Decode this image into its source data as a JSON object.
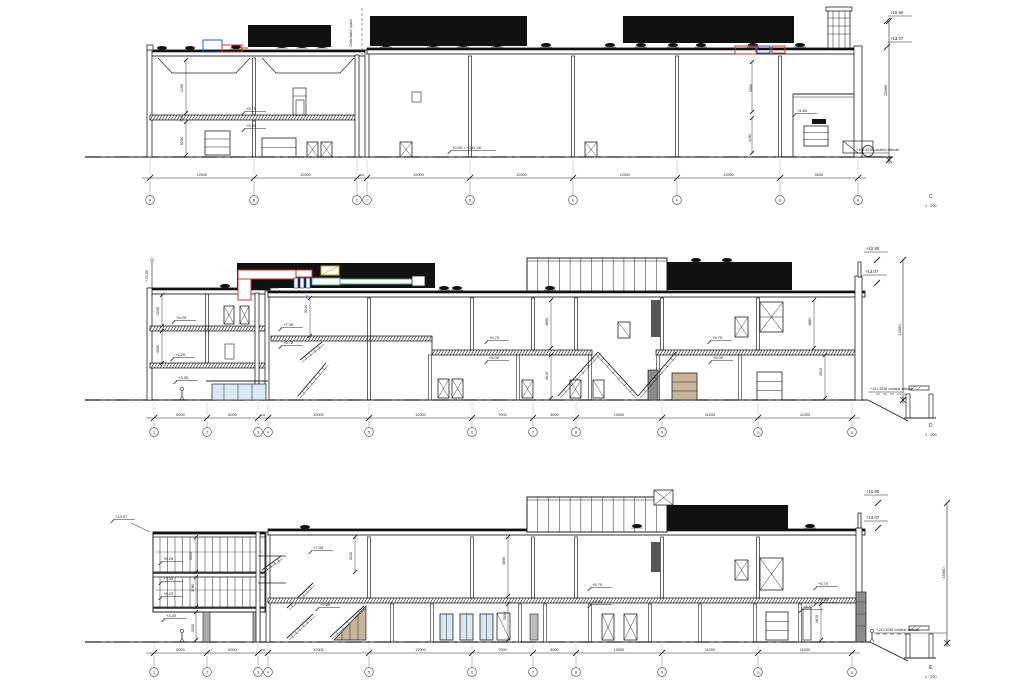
{
  "drawing": {
    "background": "#ffffff",
    "line_color": "#222222",
    "datum_text": "+141.3238 volutine altitude",
    "colors": {
      "mass": "#111111",
      "duct_red": "#cc3333",
      "duct_blue": "#3355bb",
      "duct_green": "#44a06a",
      "duct_yellow": "#c9a227",
      "glass": "#d8e8f2",
      "stair_tan": "#c8b49a",
      "shaft_gray": "#8a8a8a"
    },
    "sections": [
      {
        "name": "C",
        "scale": "1 : 200",
        "height_dim": "15980",
        "top_level": "+15.90",
        "mid_level": "+13.07",
        "grids": [
          {
            "label": "A",
            "x": 150
          },
          {
            "label": "B",
            "x": 254
          },
          {
            "label": "C",
            "x": 357
          },
          {
            "label": "C'",
            "x": 367
          },
          {
            "label": "D",
            "x": 470
          },
          {
            "label": "E",
            "x": 573
          },
          {
            "label": "F",
            "x": 677
          },
          {
            "label": "G",
            "x": 780
          },
          {
            "label": "H",
            "x": 858
          }
        ],
        "spans": [
          "12000",
          "12000",
          "600",
          "12000",
          "12000",
          "12000",
          "12000",
          "9000"
        ],
        "annotations": [
          {
            "t": "+5.70",
            "x": 246,
            "y": 110,
            "k": "lvl"
          },
          {
            "t": "+5.30",
            "x": 246,
            "y": 127,
            "k": "lvl"
          },
          {
            "t": "4190",
            "x": 183,
            "y": 88,
            "k": "dim"
          },
          {
            "t": "700",
            "x": 183,
            "y": 119,
            "k": "dim"
          },
          {
            "t": "5200",
            "x": 183,
            "y": 141,
            "k": "dim"
          },
          {
            "t": "+0.00 = +141.40",
            "x": 452,
            "y": 149,
            "k": "lvl",
            "len": 44
          },
          {
            "t": "+4.60",
            "x": 797,
            "y": 112,
            "k": "lvl"
          },
          {
            "t": "5680",
            "x": 752,
            "y": 88,
            "k": "dim"
          },
          {
            "t": "4150",
            "x": 751,
            "y": 138,
            "k": "dim"
          },
          {
            "t": "Deformační spára",
            "x": 352,
            "y": 33,
            "k": "vnote"
          }
        ]
      },
      {
        "name": "D",
        "scale": "1 : 200",
        "height_dim": "15980",
        "top_level": "+15.90",
        "mid_level": "+13.07",
        "grids": [
          {
            "label": "1",
            "x": 154
          },
          {
            "label": "2",
            "x": 207
          },
          {
            "label": "3",
            "x": 258
          },
          {
            "label": "4",
            "x": 268
          },
          {
            "label": "5",
            "x": 369
          },
          {
            "label": "6",
            "x": 472
          },
          {
            "label": "7",
            "x": 533
          },
          {
            "label": "8",
            "x": 576
          },
          {
            "label": "9",
            "x": 662
          },
          {
            "label": "10",
            "x": 758
          },
          {
            "label": "11",
            "x": 852
          }
        ],
        "spans": [
          "6000",
          "6000",
          "600",
          "12000",
          "12000",
          "7000",
          "5000",
          "10000",
          "11000",
          "11000"
        ],
        "annotations": [
          {
            "t": "+15.90",
            "x": 148,
            "y": 276,
            "k": "dim"
          },
          {
            "t": "3230",
            "x": 159,
            "y": 311,
            "k": "dim"
          },
          {
            "t": "4050",
            "x": 159,
            "y": 349,
            "k": "dim"
          },
          {
            "t": "+8.25",
            "x": 176,
            "y": 319,
            "k": "lvl"
          },
          {
            "t": "+4.20",
            "x": 175,
            "y": 356,
            "k": "lvl"
          },
          {
            "t": "+3.30",
            "x": 178,
            "y": 379,
            "k": "lvl"
          },
          {
            "t": "+7.35",
            "x": 283,
            "y": 326,
            "k": "lvl"
          },
          {
            "t": "+6.78",
            "x": 283,
            "y": 344,
            "k": "lvl"
          },
          {
            "t": "3240",
            "x": 307,
            "y": 309,
            "k": "dim"
          },
          {
            "t": "+5.70",
            "x": 489,
            "y": 339,
            "k": "lvl"
          },
          {
            "t": "+5.30",
            "x": 489,
            "y": 359,
            "k": "lvl"
          },
          {
            "t": "4890",
            "x": 548,
            "y": 322,
            "k": "dim"
          },
          {
            "t": "4515",
            "x": 548,
            "y": 376,
            "k": "dim"
          },
          {
            "t": "+5.70",
            "x": 712,
            "y": 339,
            "k": "lvl"
          },
          {
            "t": "+5.00",
            "x": 713,
            "y": 359,
            "k": "lvl"
          },
          {
            "t": "4880",
            "x": 811,
            "y": 322,
            "k": "dim"
          },
          {
            "t": "4510",
            "x": 822,
            "y": 372,
            "k": "dim"
          }
        ]
      },
      {
        "name": "E",
        "scale": "1 : 200",
        "height_dim": "15980",
        "top_level": "+15.90",
        "mid_level": "+13.07",
        "grids": [
          {
            "label": "1",
            "x": 154
          },
          {
            "label": "2",
            "x": 207
          },
          {
            "label": "3",
            "x": 258
          },
          {
            "label": "4",
            "x": 268
          },
          {
            "label": "5",
            "x": 369
          },
          {
            "label": "6",
            "x": 472
          },
          {
            "label": "7",
            "x": 533
          },
          {
            "label": "8",
            "x": 576
          },
          {
            "label": "9",
            "x": 662
          },
          {
            "label": "10",
            "x": 758
          },
          {
            "label": "11",
            "x": 852
          }
        ],
        "spans": [
          "6000",
          "6000",
          "600",
          "12000",
          "12000",
          "7000",
          "5000",
          "10000",
          "11000",
          "11000"
        ],
        "annotations": [
          {
            "t": "+13.07",
            "x": 115,
            "y": 518,
            "k": "lvl"
          },
          {
            "t": "+8.25",
            "x": 163,
            "y": 560,
            "k": "lvl"
          },
          {
            "t": "+7.35",
            "x": 163,
            "y": 580,
            "k": "lvl"
          },
          {
            "t": "+4.20",
            "x": 163,
            "y": 595,
            "k": "lvl"
          },
          {
            "t": "+3.20",
            "x": 166,
            "y": 617,
            "k": "lvl"
          },
          {
            "t": "3500",
            "x": 192,
            "y": 556,
            "k": "dim"
          },
          {
            "t": "3780",
            "x": 194,
            "y": 588,
            "k": "dim"
          },
          {
            "t": "3200",
            "x": 194,
            "y": 628,
            "k": "dim"
          },
          {
            "t": "3240",
            "x": 352,
            "y": 556,
            "k": "dim"
          },
          {
            "t": "+7.35",
            "x": 313,
            "y": 549,
            "k": "lvl"
          },
          {
            "t": "+3.85",
            "x": 320,
            "y": 606,
            "k": "lvl"
          },
          {
            "t": "4890",
            "x": 505,
            "y": 561,
            "k": "dim"
          },
          {
            "t": "3030",
            "x": 506,
            "y": 616,
            "k": "dim"
          },
          {
            "t": "+5.70",
            "x": 592,
            "y": 586,
            "k": "lvl"
          },
          {
            "t": "+5.00",
            "x": 592,
            "y": 603,
            "k": "lvl"
          },
          {
            "t": "+5.70",
            "x": 818,
            "y": 585,
            "k": "lvl"
          },
          {
            "t": "+5.00",
            "x": 818,
            "y": 601,
            "k": "lvl"
          },
          {
            "t": "+4.81",
            "x": 803,
            "y": 608,
            "k": "lvl"
          },
          {
            "t": "4810",
            "x": 818,
            "y": 619,
            "k": "dim"
          }
        ]
      }
    ]
  }
}
